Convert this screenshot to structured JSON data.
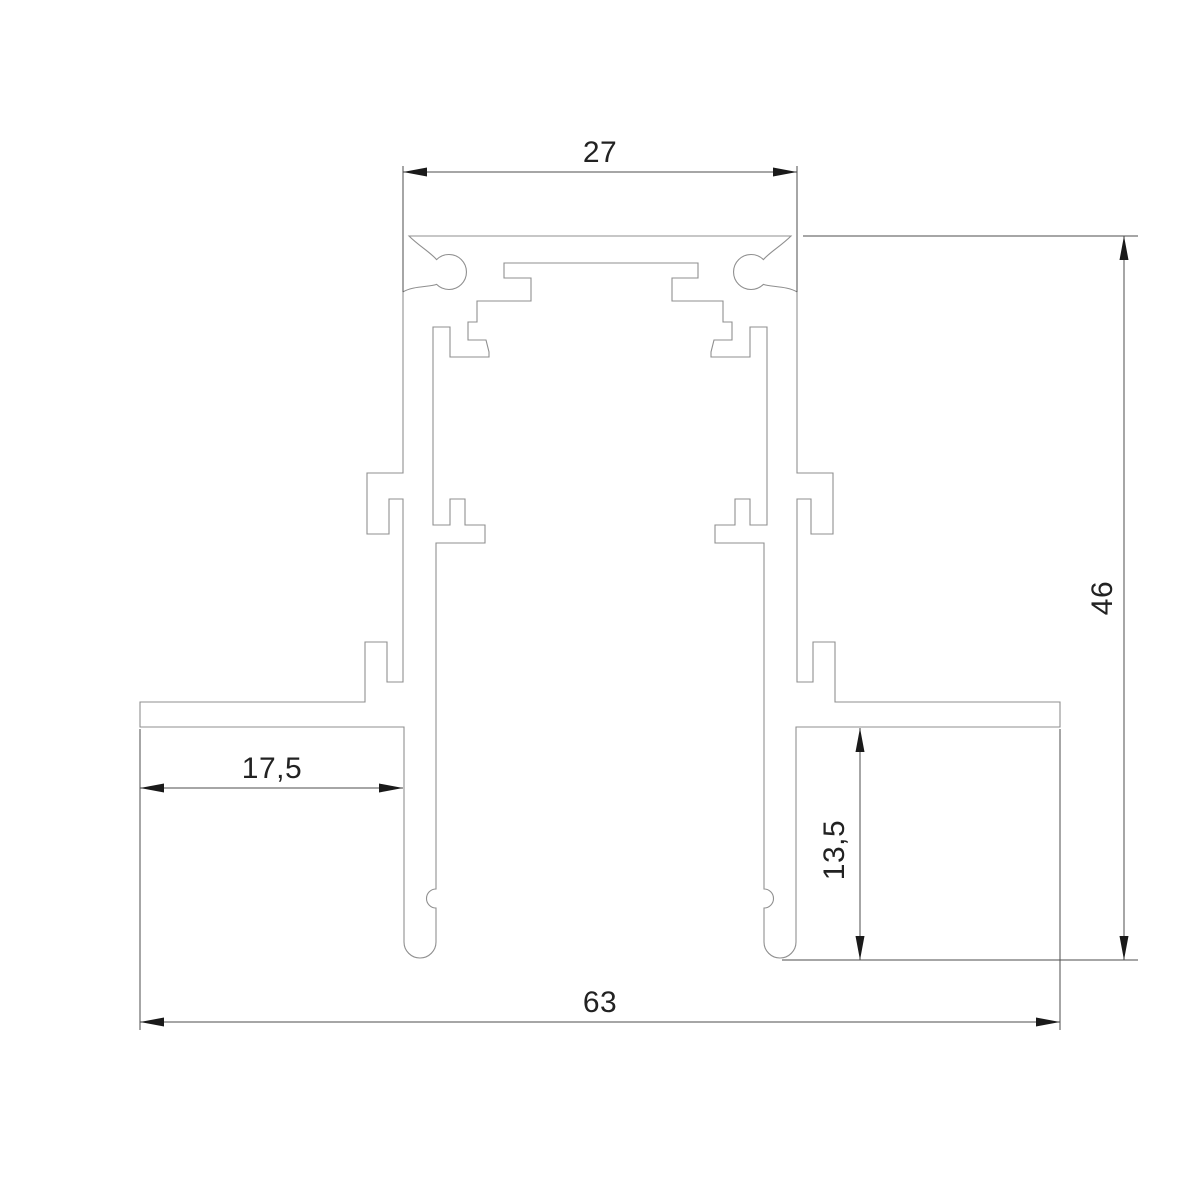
{
  "drawing": {
    "kind": "profile-cross-section",
    "dimensions": {
      "top_width": "27",
      "overall_height": "46",
      "flange_width": "17,5",
      "leg_depth": "13,5",
      "overall_width": "63"
    },
    "colors": {
      "background": "#ffffff",
      "profile_line": "#8f8f8f",
      "dimension_line": "#4d4d4d",
      "arrow": "#1a1a1a",
      "text": "#222222"
    }
  }
}
